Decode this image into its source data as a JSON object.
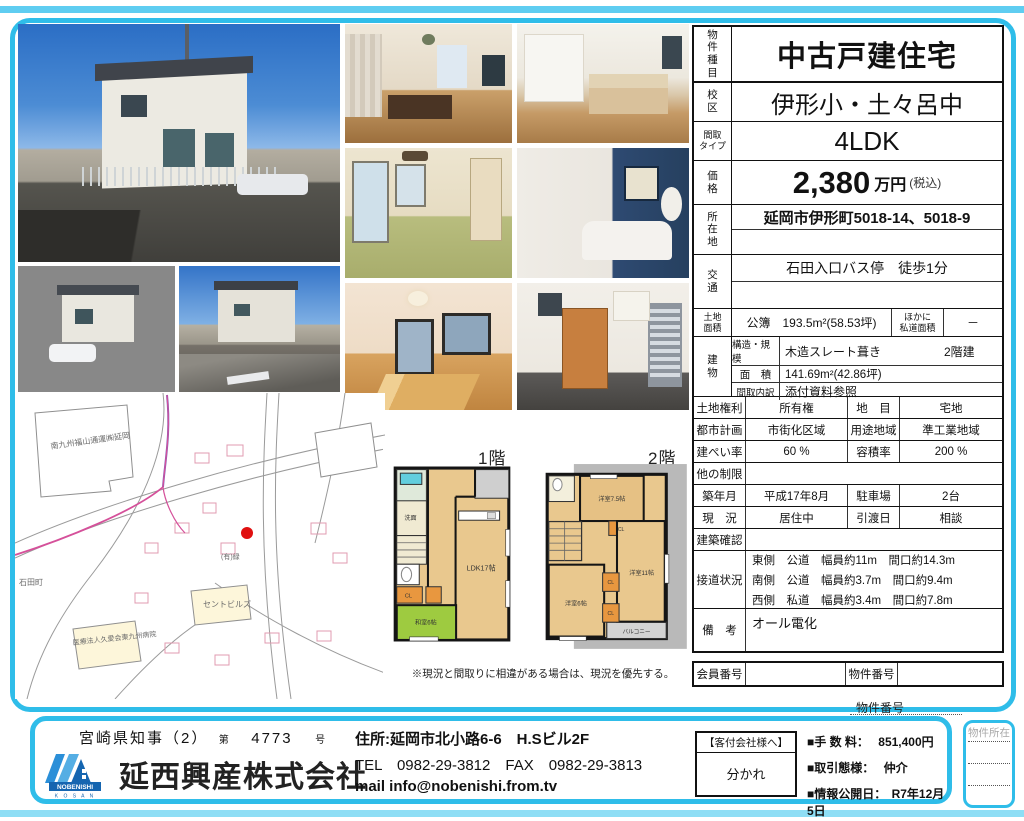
{
  "colors": {
    "accent_cyan": "#2fbde9",
    "tatami_green": "#9ecb40",
    "closet_orange": "#e8973f",
    "marker_red": "#e01010"
  },
  "property": {
    "type_label": "物\n件\n種\n目",
    "type_value": "中古戸建住宅",
    "school_label": "校\n区",
    "school_value": "伊形小・土々呂中",
    "madori_label": "間取\nタイプ",
    "madori_value": "4LDK",
    "price_label": "価\n格",
    "price_value": "2,380",
    "price_unit": "万円",
    "price_tax": "(税込)",
    "address_label": "所\n在\n地",
    "address_value": "延岡市伊形町5018-14、5018-9",
    "access_label": "交\n通",
    "access_value": "石田入口バス停　徒歩1分",
    "land_label": "土地\n面積",
    "land_value": "公簿　193.5m²(58.53坪)",
    "land_other_label": "ほかに\n私道面積",
    "land_other_value": "－",
    "building_label": "建\n物",
    "structure_label": "構造・規模",
    "structure_value": "木造スレート葺き",
    "structure_floors": "2階建",
    "area_label": "面　積",
    "area_value": "141.69m²(42.86坪)",
    "madori_detail_label": "間取内訳",
    "madori_detail_value": "添付資料参照",
    "land_right_label": "土地権利",
    "land_right_value": "所有権",
    "chimoku_label": "地　目",
    "chimoku_value": "宅地",
    "city_plan_label": "都市計画",
    "city_plan_value": "市街化区域",
    "yoto_label": "用途地域",
    "yoto_value": "準工業地域",
    "kenpei_label": "建ぺい率",
    "kenpei_value": "60 %",
    "yoseki_label": "容積率",
    "yoseki_value": "200 %",
    "other_limit_label": "他の制限",
    "other_limit_value": "",
    "built_label": "築年月",
    "built_value": "平成17年8月",
    "parking_label": "駐車場",
    "parking_value": "2台",
    "status_label": "現　況",
    "status_value": "居住中",
    "handover_label": "引渡日",
    "handover_value": "相談",
    "kenchiku_label": "建築確認",
    "kenchiku_value": "",
    "road_label": "接道状況",
    "road_line1": "東側　公道　幅員約11m　間口約14.3m",
    "road_line2": "南側　公道　幅員約3.7m　間口約9.4m",
    "road_line3": "西側　私道　幅員約3.4m　間口約7.8m",
    "biko_label": "備　考",
    "biko_value": "オール電化",
    "member_label": "会員番号",
    "member_value": "",
    "bukken_label": "物件番号",
    "bukken_value": ""
  },
  "floorplan": {
    "floor1_label": "1階",
    "floor2_label": "2階",
    "f1_ldk": "LDK17帖",
    "f1_washroom": "洗面",
    "f1_tatami": "和室6帖",
    "f1_cl": "CL",
    "f2_room75": "洋室7.5帖",
    "f2_room11": "洋室11帖",
    "f2_room6": "洋室6帖",
    "f2_cl1": "CL",
    "f2_cl2": "CL",
    "f2_cl3": "CL",
    "f2_balcony": "バルコニー",
    "note": "※現況と間取りに相違がある場合は、現況を優先する。"
  },
  "map": {
    "labels": [
      "南九州福山通運㈱延岡",
      "石田町",
      "セントビルズ",
      "医療法人久愛会東九州病院",
      "(有)緑"
    ]
  },
  "footer": {
    "license_pref": "宮崎県知事（2）",
    "license_dai": "第",
    "license_no": "4773",
    "license_go": "号",
    "company": "延西興産株式会社",
    "logo_name": "NOBENISHI",
    "logo_sub": "K O S A N",
    "address": "住所:延岡市北小路6-6　H.Sビル2F",
    "tel": "TEL　0982-29-3812　FAX　0982-29-3813",
    "mail": "mail info@nobenishi.from.tv",
    "kyakutsuke_title": "【客付会社様へ】",
    "kyakutsuke_value": "分かれ",
    "fee_label": "■手 数 料：",
    "fee_value": "851,400円",
    "torihiki_label": "■取引態様：",
    "torihiki_value": "仲介",
    "publish_label": "■情報公開日：",
    "publish_value": "R7年12月5日",
    "bukken_no_label": "物件番号",
    "bukken_location_label": "物件所在"
  }
}
